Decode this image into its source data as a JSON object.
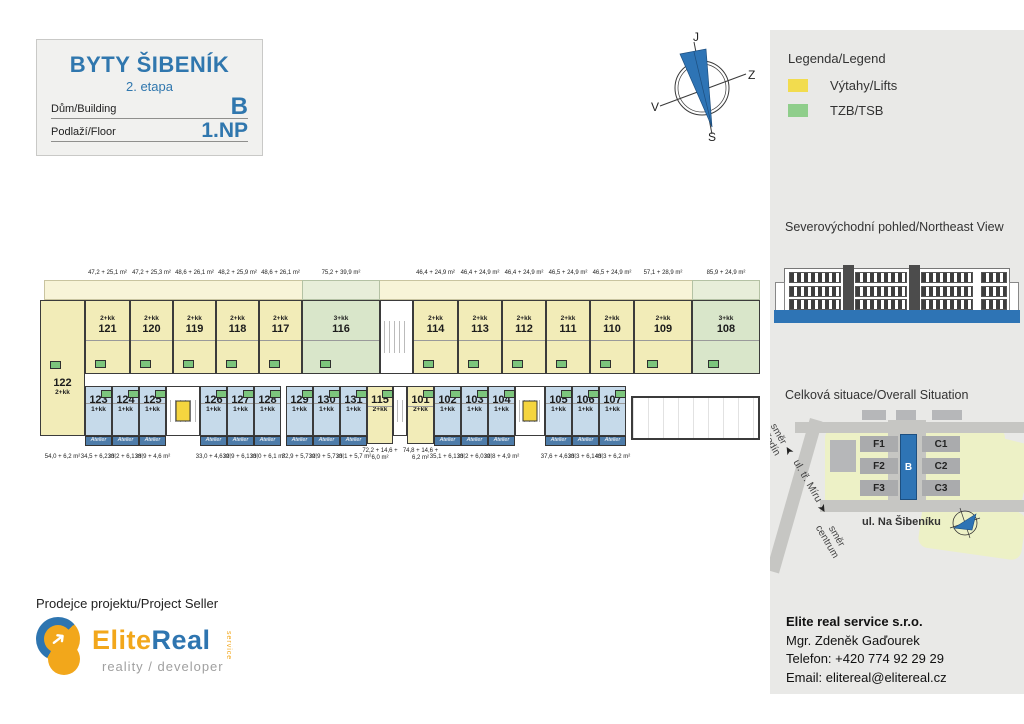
{
  "title_block": {
    "project": "BYTY ŠIBENÍK",
    "stage": "2. etapa",
    "building_label": "Dům/Building",
    "building_value": "B",
    "floor_label": "Podlaží/Floor",
    "floor_value": "1.NP"
  },
  "compass": {
    "top": "J",
    "right": "Z",
    "left": "V",
    "bottom": "S"
  },
  "legend": {
    "title": "Legenda/Legend",
    "items": [
      {
        "label": "Výtahy/Lifts",
        "color": "#f2dc4e"
      },
      {
        "label": "TZB/TSB",
        "color": "#8fce8b"
      }
    ]
  },
  "sections": {
    "northeast_view": "Severovýchodní pohled/Northeast View",
    "overall_situation": "Celková situace/Overall Situation"
  },
  "site_plan": {
    "f1": "F1",
    "f2": "F2",
    "f3": "F3",
    "b": "B",
    "c1": "C1",
    "c2": "C2",
    "c3": "C3",
    "street": "ul. Na Šibeníku",
    "road_label": "ul. tř. Míru",
    "direction_top": "směr\nNeředín",
    "direction_bottom": "směr\ncentrum",
    "arrow": "➤"
  },
  "seller": {
    "heading": "Prodejce projektu/Project Seller",
    "brand_primary": "Elite",
    "brand_secondary": "Real",
    "brand_service": "service",
    "tagline": "reality / developer",
    "arrow_glyph": "➜"
  },
  "contact": {
    "company": "Elite real service s.r.o.",
    "person": "Mgr. Zdeněk Gaďourek",
    "phone": "Telefon: +420 774 92 29 29",
    "email": "Email: elitereal@elitereal.cz"
  },
  "floor_plan": {
    "atelier_label": "Atelier",
    "garden": [
      {
        "x": 4,
        "w": 716,
        "fill": "yellow"
      },
      {
        "x": 262,
        "w": 78,
        "fill": "green"
      },
      {
        "x": 652,
        "w": 68,
        "fill": "green"
      }
    ],
    "unit_122": {
      "id": "122",
      "type": "2+kk",
      "area": "54,0 + 6,2 m²",
      "x": 0,
      "w": 45
    },
    "top_units": [
      {
        "id": "121",
        "type": "2+kk",
        "area": "47,2 + 25,1 m²",
        "x": 45,
        "w": 45,
        "fill": "yellow"
      },
      {
        "id": "120",
        "type": "2+kk",
        "area": "47,2 + 25,3 m²",
        "x": 90,
        "w": 43,
        "fill": "yellow"
      },
      {
        "id": "119",
        "type": "2+kk",
        "area": "48,6 + 26,1 m²",
        "x": 133,
        "w": 43,
        "fill": "yellow"
      },
      {
        "id": "118",
        "type": "2+kk",
        "area": "48,2 + 25,9 m²",
        "x": 176,
        "w": 43,
        "fill": "yellow"
      },
      {
        "id": "117",
        "type": "2+kk",
        "area": "48,6 + 26,1 m²",
        "x": 219,
        "w": 43,
        "fill": "yellow"
      },
      {
        "id": "116",
        "type": "3+kk",
        "area": "75,2 + 39,9 m²",
        "x": 262,
        "w": 78,
        "fill": "green"
      },
      {
        "id": "114",
        "type": "2+kk",
        "area": "46,4 + 24,9 m²",
        "x": 373,
        "w": 45,
        "fill": "yellow"
      },
      {
        "id": "113",
        "type": "2+kk",
        "area": "46,4 + 24,9 m²",
        "x": 418,
        "w": 44,
        "fill": "yellow"
      },
      {
        "id": "112",
        "type": "2+kk",
        "area": "46,4 + 24,9 m²",
        "x": 462,
        "w": 44,
        "fill": "yellow"
      },
      {
        "id": "111",
        "type": "2+kk",
        "area": "46,5 + 24,9 m²",
        "x": 506,
        "w": 44,
        "fill": "yellow"
      },
      {
        "id": "110",
        "type": "2+kk",
        "area": "46,5 + 24,9 m²",
        "x": 550,
        "w": 44,
        "fill": "yellow"
      },
      {
        "id": "109",
        "type": "2+kk",
        "area": "57,1 + 28,9 m²",
        "x": 594,
        "w": 58,
        "fill": "yellow"
      },
      {
        "id": "108",
        "type": "3+kk",
        "area": "85,9 + 24,9 m²",
        "x": 652,
        "w": 68,
        "fill": "green"
      }
    ],
    "bottom_units": [
      {
        "id": "123",
        "type": "1+kk",
        "area": "34,5 + 6,2 m²",
        "x": 45,
        "w": 27,
        "fill": "blue",
        "atelier": true
      },
      {
        "id": "124",
        "type": "1+kk",
        "area": "33,2 + 6,1 m²",
        "x": 72,
        "w": 27,
        "fill": "blue",
        "atelier": true
      },
      {
        "id": "125",
        "type": "1+kk",
        "area": "38,9 + 4,6 m²",
        "x": 99,
        "w": 27,
        "fill": "blue",
        "atelier": true
      },
      {
        "id": "126",
        "type": "1+kk",
        "area": "33,0 + 4,6 m²",
        "x": 160,
        "w": 27,
        "fill": "blue",
        "atelier": true
      },
      {
        "id": "127",
        "type": "1+kk",
        "area": "32,9 + 6,1 m²",
        "x": 187,
        "w": 27,
        "fill": "blue",
        "atelier": true
      },
      {
        "id": "128",
        "type": "1+kk",
        "area": "33,0 + 6,1 m²",
        "x": 214,
        "w": 27,
        "fill": "blue",
        "atelier": true
      },
      {
        "id": "129",
        "type": "1+kk",
        "area": "32,9 + 5,7 m²",
        "x": 246,
        "w": 27,
        "fill": "blue",
        "atelier": true
      },
      {
        "id": "130",
        "type": "1+kk",
        "area": "32,9 + 5,7 m²",
        "x": 273,
        "w": 27,
        "fill": "blue",
        "atelier": true
      },
      {
        "id": "131",
        "type": "1+kk",
        "area": "33,1 + 5,7 m²",
        "x": 300,
        "w": 27,
        "fill": "blue",
        "atelier": true
      },
      {
        "id": "115",
        "type": "2+kk",
        "area_lines": [
          "72,2 + 14,6 +",
          "6,0 m²"
        ],
        "x": 327,
        "w": 26,
        "fill": "yellow",
        "tall": true
      },
      {
        "id": "101",
        "type": "2+kk",
        "area_lines": [
          "74,8 + 14,6 +",
          "6,2 m²"
        ],
        "x": 367,
        "w": 27,
        "fill": "yellow",
        "tall": true
      },
      {
        "id": "102",
        "type": "1+kk",
        "area": "35,1 + 6,1 m²",
        "x": 394,
        "w": 27,
        "fill": "blue",
        "atelier": true
      },
      {
        "id": "103",
        "type": "1+kk",
        "area": "33,2 + 6,0 m²",
        "x": 421,
        "w": 27,
        "fill": "blue",
        "atelier": true
      },
      {
        "id": "104",
        "type": "1+kk",
        "area": "32,8 + 4,9 m²",
        "x": 448,
        "w": 27,
        "fill": "blue",
        "atelier": true
      },
      {
        "id": "105",
        "type": "1+kk",
        "area": "37,6 + 4,6 m²",
        "x": 505,
        "w": 27,
        "fill": "blue",
        "atelier": true
      },
      {
        "id": "106",
        "type": "1+kk",
        "area": "33,3 + 6,1 m²",
        "x": 532,
        "w": 27,
        "fill": "blue",
        "atelier": true
      },
      {
        "id": "107",
        "type": "1+kk",
        "area": "43,3 + 6,2 m²",
        "x": 559,
        "w": 27,
        "fill": "blue",
        "atelier": true
      }
    ],
    "cores": [
      {
        "x": 340,
        "w": 33,
        "row": "top",
        "elevator": false
      },
      {
        "x": 126,
        "w": 34,
        "row": "bottom",
        "elevator": true
      },
      {
        "x": 353,
        "w": 14,
        "row": "bottom",
        "elevator": false
      },
      {
        "x": 475,
        "w": 30,
        "row": "bottom",
        "elevator": true
      }
    ],
    "garage": {
      "x": 591,
      "w": 129,
      "y": 128,
      "h": 44
    }
  }
}
